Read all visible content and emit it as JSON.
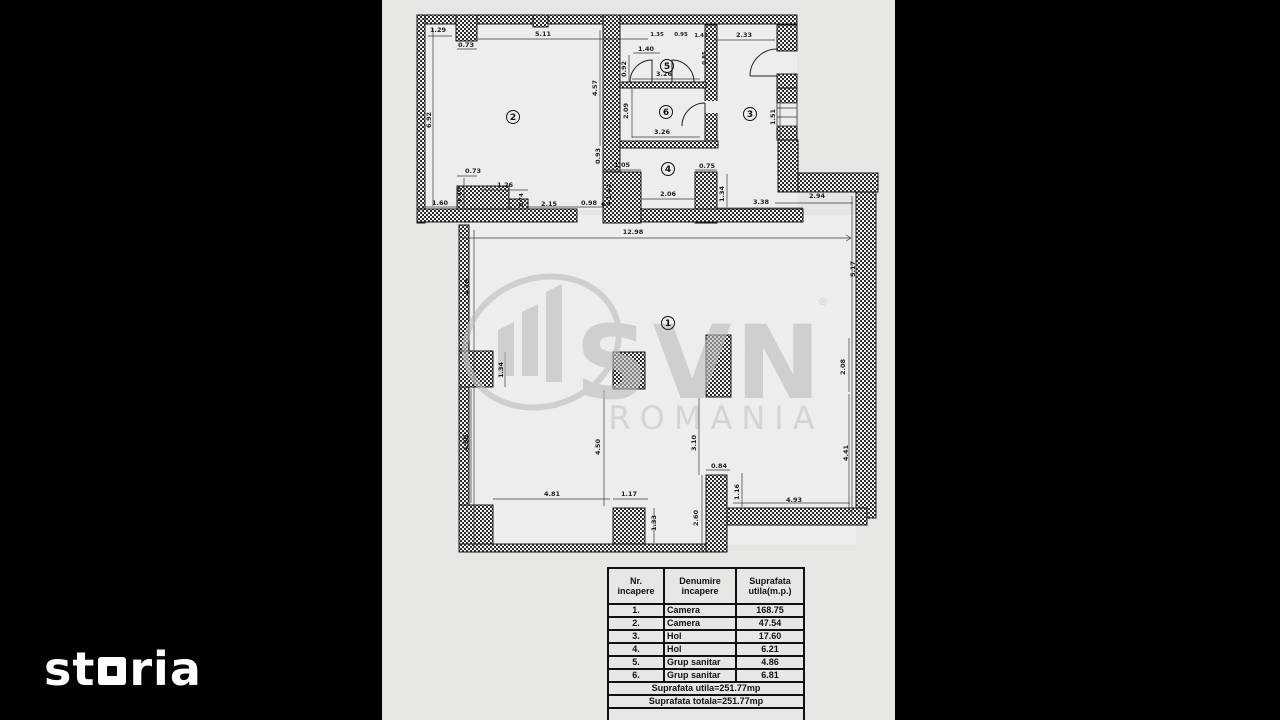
{
  "branding": {
    "storia_prefix": "st",
    "storia_suffix": "ria",
    "watermark": {
      "brand": "SVN",
      "registered": "®",
      "region": "ROMANIA"
    }
  },
  "colors": {
    "background": "#000000",
    "paper": "#e8e6e3",
    "ink": "#111111",
    "watermark": "#bdbcbb",
    "logo_white": "#ffffff"
  },
  "floorplan": {
    "room_labels": [
      {
        "n": "1",
        "x": 668,
        "y": 323
      },
      {
        "n": "2",
        "x": 513,
        "y": 117
      },
      {
        "n": "3",
        "x": 750,
        "y": 114
      },
      {
        "n": "4",
        "x": 668,
        "y": 169
      },
      {
        "n": "5",
        "x": 667,
        "y": 66
      },
      {
        "n": "6",
        "x": 666,
        "y": 112
      }
    ],
    "dimensions": [
      {
        "t": "1.29",
        "x": 438,
        "y": 32
      },
      {
        "t": "5.11",
        "x": 543,
        "y": 36
      },
      {
        "t": "0.73",
        "x": 466,
        "y": 47
      },
      {
        "t": "6.92",
        "x": 431,
        "y": 120,
        "v": 1
      },
      {
        "t": "4.57",
        "x": 597,
        "y": 88,
        "v": 1
      },
      {
        "t": "1.35",
        "x": 657,
        "y": 36,
        "s": 1
      },
      {
        "t": "0.95",
        "x": 681,
        "y": 36,
        "s": 1
      },
      {
        "t": "1.45",
        "x": 701,
        "y": 37,
        "s": 1
      },
      {
        "t": "1.40",
        "x": 646,
        "y": 51
      },
      {
        "t": "0.92",
        "x": 626,
        "y": 69,
        "v": 1
      },
      {
        "t": "0.85",
        "x": 706,
        "y": 58,
        "v": 1,
        "s": 1
      },
      {
        "t": "3.26",
        "x": 664,
        "y": 76
      },
      {
        "t": "2.33",
        "x": 744,
        "y": 37
      },
      {
        "t": "2.09",
        "x": 628,
        "y": 111,
        "v": 1
      },
      {
        "t": "3.26",
        "x": 662,
        "y": 134
      },
      {
        "t": "1.51",
        "x": 775,
        "y": 117,
        "v": 1
      },
      {
        "t": "0.93",
        "x": 600,
        "y": 156,
        "v": 1
      },
      {
        "t": "1.05",
        "x": 622,
        "y": 167
      },
      {
        "t": "0.75",
        "x": 707,
        "y": 168
      },
      {
        "t": "1.42",
        "x": 611,
        "y": 192,
        "v": 1
      },
      {
        "t": "2.06",
        "x": 668,
        "y": 196
      },
      {
        "t": "1.34",
        "x": 724,
        "y": 194,
        "v": 1
      },
      {
        "t": "0.73",
        "x": 473,
        "y": 173
      },
      {
        "t": "1.19",
        "x": 461,
        "y": 195,
        "v": 1
      },
      {
        "t": "1.26",
        "x": 505,
        "y": 187
      },
      {
        "t": "1.60",
        "x": 440,
        "y": 205
      },
      {
        "t": "0.74",
        "x": 523,
        "y": 200,
        "v": 1,
        "s": 1
      },
      {
        "t": "2.15",
        "x": 549,
        "y": 206
      },
      {
        "t": "0.98",
        "x": 589,
        "y": 205
      },
      {
        "t": "0.4",
        "x": 606,
        "y": 206,
        "s": 1
      },
      {
        "t": "3.38",
        "x": 761,
        "y": 204
      },
      {
        "t": "2.94",
        "x": 817,
        "y": 198
      },
      {
        "t": "12.98",
        "x": 633,
        "y": 234
      },
      {
        "t": "4.78",
        "x": 469,
        "y": 287,
        "v": 1
      },
      {
        "t": "5.17",
        "x": 855,
        "y": 269,
        "v": 1
      },
      {
        "t": "1.34",
        "x": 503,
        "y": 370,
        "v": 1
      },
      {
        "t": "4.50",
        "x": 468,
        "y": 443,
        "v": 1
      },
      {
        "t": "4.50",
        "x": 600,
        "y": 447,
        "v": 1
      },
      {
        "t": "3.10",
        "x": 696,
        "y": 443,
        "v": 1
      },
      {
        "t": "2.08",
        "x": 845,
        "y": 367,
        "v": 1
      },
      {
        "t": "4.41",
        "x": 848,
        "y": 453,
        "v": 1
      },
      {
        "t": "4.81",
        "x": 552,
        "y": 496
      },
      {
        "t": "1.17",
        "x": 629,
        "y": 496
      },
      {
        "t": "1.33",
        "x": 656,
        "y": 523,
        "v": 1
      },
      {
        "t": "2.60",
        "x": 698,
        "y": 518,
        "v": 1
      },
      {
        "t": "0.84",
        "x": 719,
        "y": 468
      },
      {
        "t": "1.16",
        "x": 739,
        "y": 492,
        "v": 1
      },
      {
        "t": "4.93",
        "x": 794,
        "y": 502
      }
    ]
  },
  "table": {
    "headers": [
      "Nr.\nincapere",
      "Denumire\nincapere",
      "Suprafata\nutila(m.p.)"
    ],
    "rows": [
      [
        "1.",
        "Camera",
        "168.75"
      ],
      [
        "2.",
        "Camera",
        "47.54"
      ],
      [
        "3.",
        "Hol",
        "17.60"
      ],
      [
        "4.",
        "Hol",
        "6.21"
      ],
      [
        "5.",
        "Grup sanitar",
        "4.86"
      ],
      [
        "6.",
        "Grup sanitar",
        "6.81"
      ]
    ],
    "footers": [
      "Suprafata utila=251.77mp",
      "Suprafata totala=251.77mp"
    ]
  }
}
